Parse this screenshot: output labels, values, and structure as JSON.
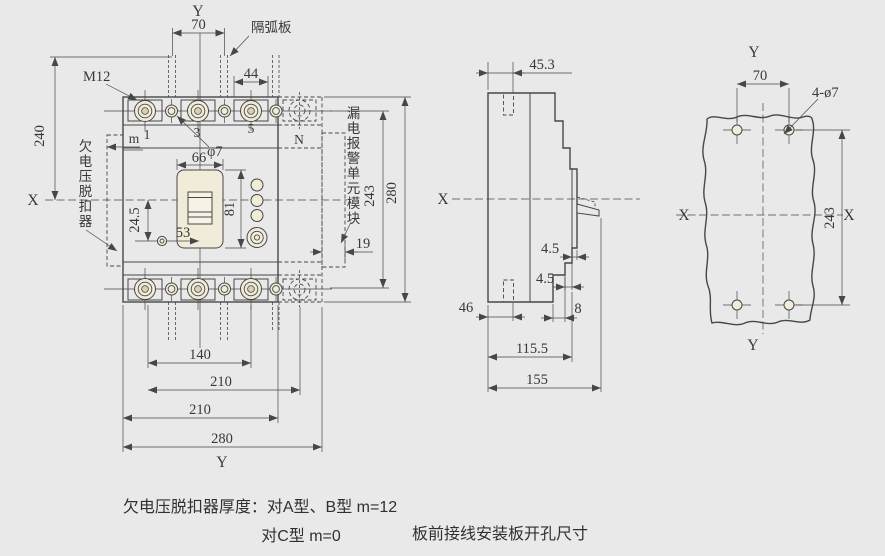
{
  "colors": {
    "background": "#e9e9e9",
    "line": "#474747",
    "text": "#383838",
    "cream": "#f1ecd9",
    "cream_dark": "#d9d0b4"
  },
  "front_view": {
    "axis_top": "Y",
    "axis_bottom": "Y",
    "axis_left": "X",
    "terminals": [
      "1",
      "3",
      "5",
      "N"
    ],
    "dims": {
      "d70": "70",
      "d44": "44",
      "d240": "240",
      "m12": "M12",
      "phi7": "φ7",
      "m": "m",
      "d66": "66",
      "d81": "81",
      "d24_5": "24.5",
      "d53": "53",
      "d19": "19",
      "d243": "243",
      "d280_right": "280",
      "d140": "140",
      "d210_outer": "210",
      "d210_body": "210",
      "d280_bottom": "280"
    },
    "annotations": {
      "arc_barrier": "隔弧板",
      "undervoltage_release": "欠电压脱扣器",
      "leakage_alarm_module": "漏电报警单元模块"
    }
  },
  "side_view": {
    "axis_left": "X",
    "dims": {
      "d45_3": "45.3",
      "d4_5_upper": "4.5",
      "d4_5_lower": "4.5",
      "d46": "46",
      "d8": "8",
      "d115_5": "115.5",
      "d155": "155"
    }
  },
  "mounting_view": {
    "axis_top": "Y",
    "axis_bottom": "Y",
    "axis_left": "X",
    "axis_right": "X",
    "dims": {
      "d70": "70",
      "holes": "4-ø7",
      "d243": "243"
    }
  },
  "captions": {
    "line1": "欠电压脱扣器厚度：对A型、B型  m=12",
    "line2": "对C型  m=0",
    "right": "板前接线安装板开孔尺寸"
  }
}
